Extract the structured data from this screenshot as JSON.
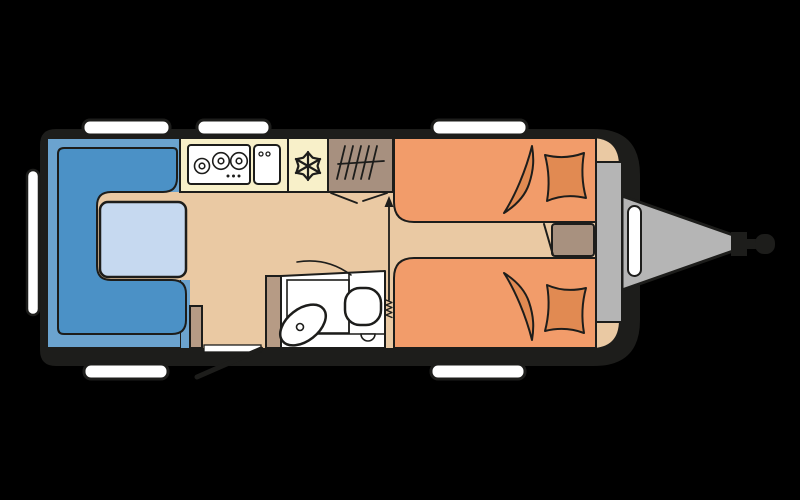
{
  "title": "Caravan floor plan – top view",
  "colors": {
    "background": "#000000",
    "body_shell": "#1d1d1b",
    "outline": "#1d1d1b",
    "floor": "#eac9a3",
    "seat_base": "#6ba3cf",
    "seat": "#4b91c6",
    "table": "#c6d9f0",
    "counter": "#f8f0c9",
    "appliance_white": "#ffffff",
    "wardrobe": "#a7907f",
    "bed": "#f29c6a",
    "bedding": "#e18a52",
    "cabinet": "#b69b85",
    "nightstand": "#a8917f",
    "storage_gray": "#b5b5b5",
    "window": "#ffffff",
    "bathroom": "#ffffff"
  },
  "icons": {
    "hob": "three burner circles with control dots",
    "kitchen_sink": "rounded square with two taps",
    "freezer": "snowflake asterisk",
    "wardrobe": "hanging rail with hanger strokes",
    "folding_door": "angled chevron lines",
    "entry_arrow": "upward arrow with spring tail",
    "bathroom_door": "quarter-circle swing arc",
    "washbasin": "tilted oval with drain",
    "toilet": "rounded bowl with half-circle base",
    "entry_door": "threshold bar with open-door line",
    "tow_hitch": "triangular A-frame with coupling head",
    "window": "rounded white bar"
  },
  "inventory": {
    "windows_top": 3,
    "windows_bottom": 2,
    "windows_rear": 1,
    "single_beds": 2,
    "dinette_seats": 1,
    "tables": 1
  }
}
